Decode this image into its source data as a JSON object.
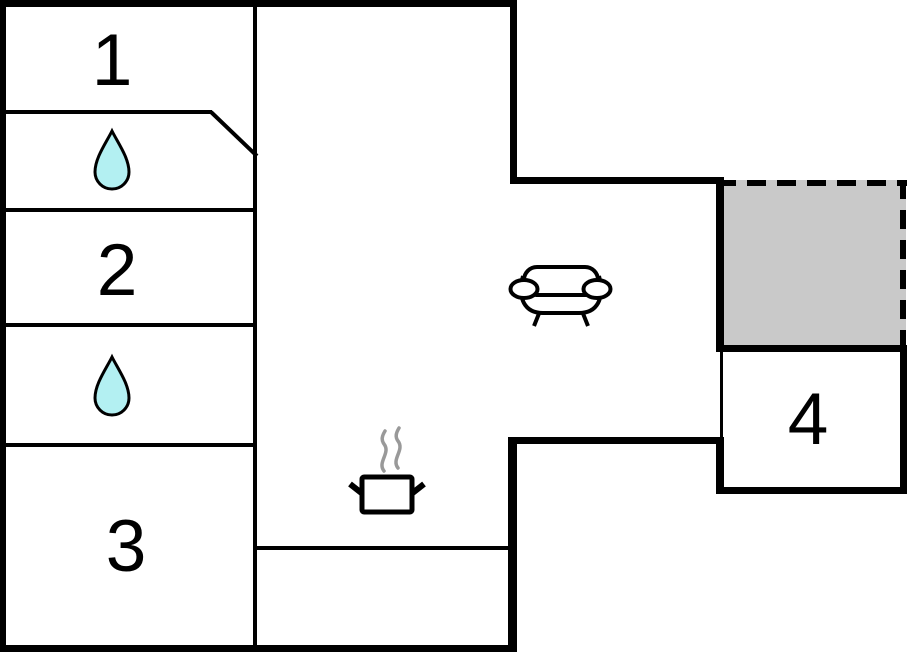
{
  "canvas": {
    "width": 908,
    "height": 652
  },
  "colors": {
    "background": "#ffffff",
    "walls": "#000000",
    "terrace_fill": "#c9c9c9",
    "drop_fill": "#b3f0f2",
    "drop_stroke": "#000000",
    "steam_stroke": "#999999"
  },
  "rooms": [
    {
      "label": "1"
    },
    {
      "label": "2"
    },
    {
      "label": "3"
    },
    {
      "label": "4"
    }
  ],
  "icons": {
    "bathroom_upper": "water-drop-icon",
    "bathroom_lower": "water-drop-icon",
    "living_area": "sofa-icon",
    "kitchen": "cooking-pot-icon"
  },
  "areas": {
    "terrace": "terrace-dashed-area"
  }
}
